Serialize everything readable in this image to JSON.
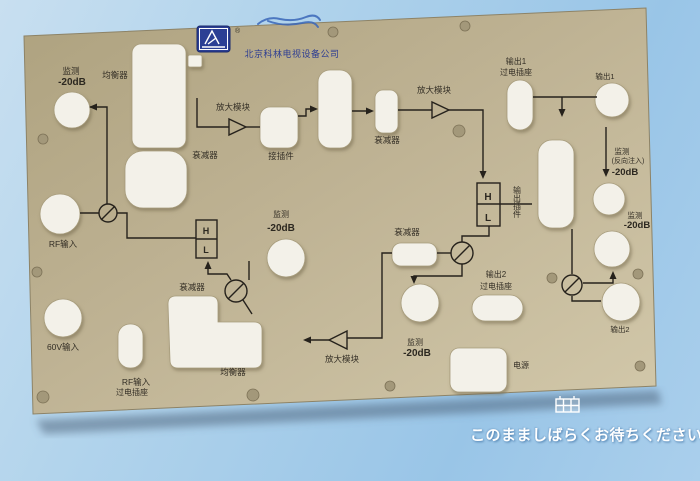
{
  "photo": {
    "description": "photo of tan CATV amplifier faceplate with printed signal-path schematic",
    "company_name": "北京科林电视设备公司",
    "registered_mark": "®",
    "labels": {
      "monitor": "监测",
      "level": "-20dB",
      "reverse_inject": "(反向注入)",
      "equalizer": "均衡器",
      "attenuator": "衰减器",
      "amp_module": "放大模块",
      "connector": "接插件",
      "output1": "输出1",
      "output2": "输出2",
      "feed_socket": "过电插座",
      "output_module": "输出插件",
      "rf_input": "RF输入",
      "v60_input": "60V输入",
      "power": "电源",
      "high": "H",
      "low": "L"
    },
    "icons": {
      "logo": "antenna-brand-logo",
      "scribble": "blue-ink-handwriting"
    }
  },
  "overlay": {
    "wait_message": "このまましばらくお待ちください。",
    "icon": "grid-placeholder-icon"
  },
  "colors": {
    "background_blue": "#a5cdeb",
    "panel_tan": "#bfb394",
    "cutout_white": "#f3f1e9",
    "schematic_ink": "#26221c",
    "logo_blue": "#2b3f94",
    "caption_white": "#ffffff",
    "icon_blue": "#8fc3ec"
  }
}
